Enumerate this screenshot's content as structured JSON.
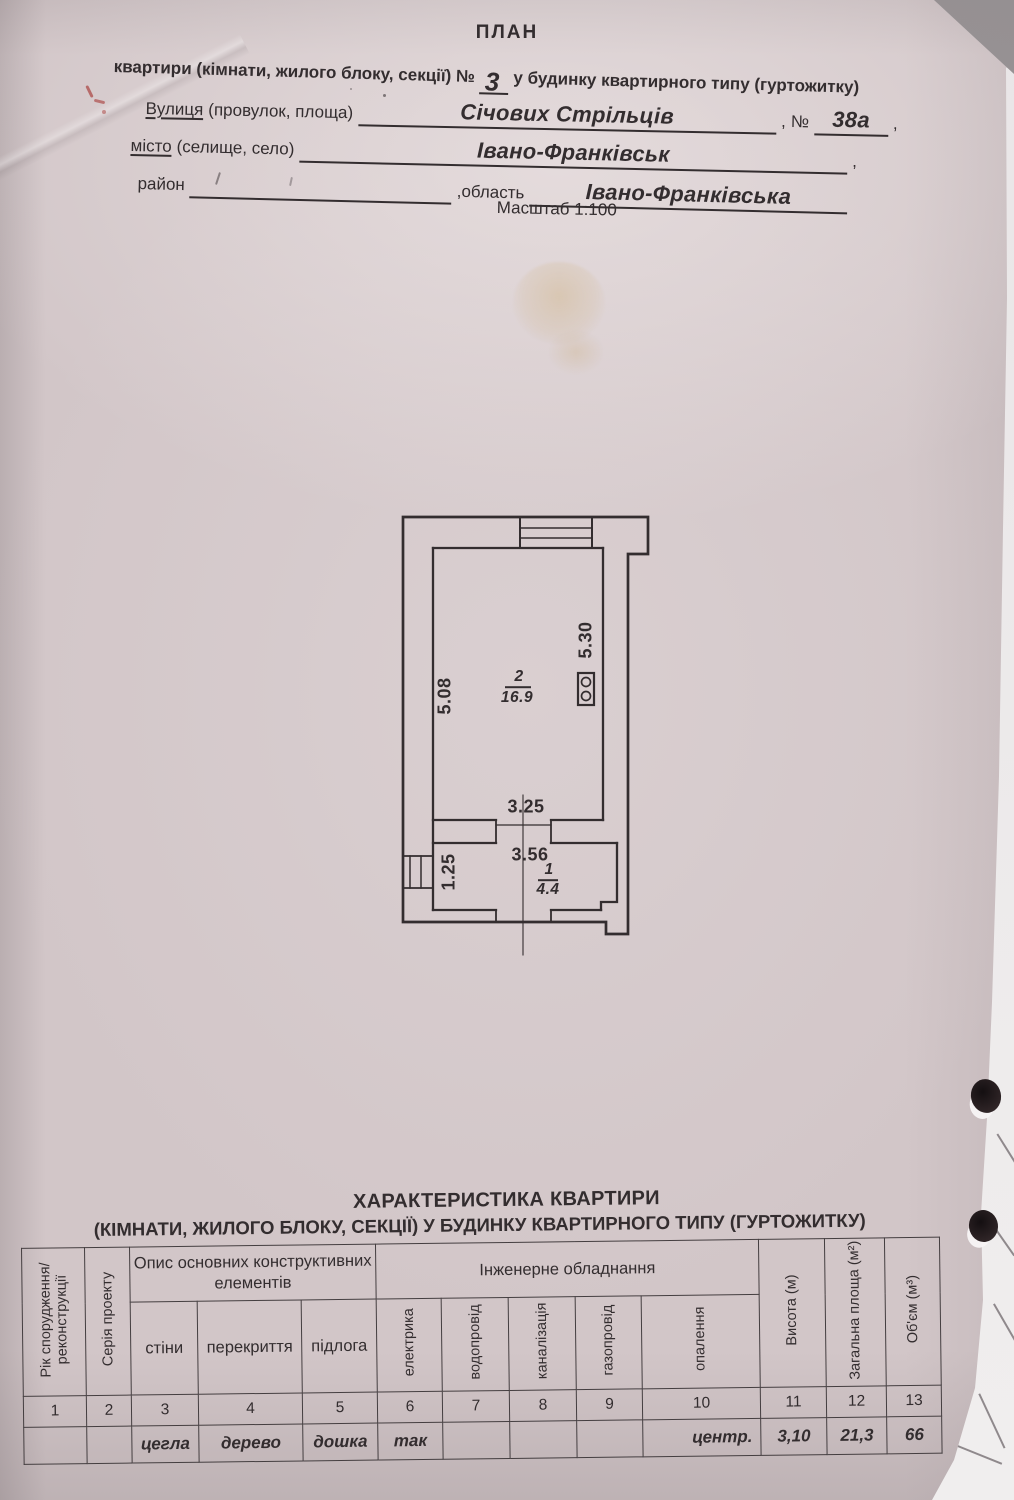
{
  "document": {
    "title": "ПЛАН",
    "subtitle_prefix": "квартири (кімнати, жилого блоку, секції) №",
    "apartment_number": "3",
    "subtitle_suffix": "у будинку квартирного типу (гуртожитку)",
    "street_label": "Вулиця",
    "street_label_paren": "(провулок, площа)",
    "street_value": "Січових Стрільців",
    "comma": ",",
    "number_sign": "№",
    "building_number": "38а",
    "city_label": "місто",
    "city_label_paren": "(селище, село)",
    "city_value": "Івано-Франківськ",
    "district_label": "район",
    "region_label": ",область",
    "region_value": "Івано-Франківська",
    "scale": "Масштаб 1:100"
  },
  "plan": {
    "room2_number": "2",
    "room2_area": "16.9",
    "room1_number": "1",
    "room1_area": "4.4",
    "dim_left_wall": "5.08",
    "dim_right_wall": "5.30",
    "dim_opening": "3.25",
    "dim_room1_width": "3.56",
    "dim_room1_depth": "1.25"
  },
  "characteristics": {
    "title": "ХАРАКТЕРИСТИКА КВАРТИРИ",
    "subtitle": "(КІМНАТИ, ЖИЛОГО БЛОКУ, СЕКЦІЇ) У БУДИНКУ КВАРТИРНОГО ТИПУ (ГУРТОЖИТКУ)",
    "headers": {
      "year": "Рік спорудження/ реконструкції",
      "series": "Серія проекту",
      "construction_group": "Опис основних конструктивних елементів",
      "walls": "стіни",
      "overlap": "перекриття",
      "floor": "підлога",
      "engineering_group": "Інженерне обладнання",
      "electricity": "електрика",
      "water": "водопровід",
      "sewerage": "каналізація",
      "gas": "газопровід",
      "heating": "опалення",
      "height": "Висота (м)",
      "total_area": "Загальна площа (м²)",
      "volume": "Об'єм (м³)"
    },
    "column_numbers": [
      "1",
      "2",
      "3",
      "4",
      "5",
      "6",
      "7",
      "8",
      "9",
      "10",
      "11",
      "12",
      "13"
    ],
    "values": [
      "",
      "",
      "цегла",
      "дерево",
      "дошка",
      "так",
      "",
      "",
      "",
      "центр.",
      "3,10",
      "21,3",
      "66"
    ]
  }
}
